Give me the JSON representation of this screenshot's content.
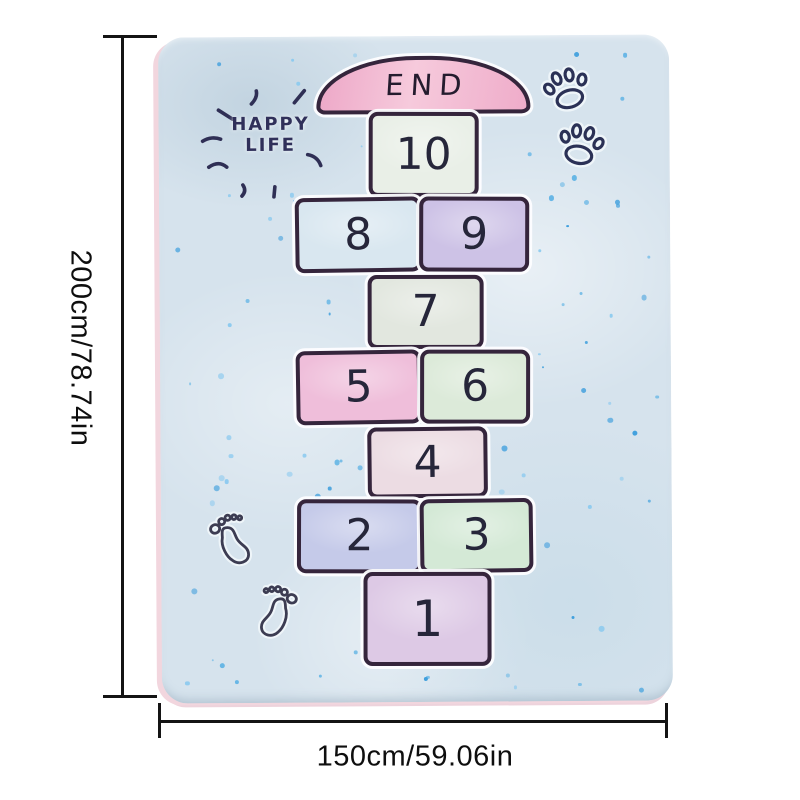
{
  "dimensions": {
    "height_label": "200cm/78.74in",
    "width_label": "150cm/59.06in",
    "line_color": "#141414"
  },
  "mat": {
    "background": "#d6e3ed",
    "edge_color": "#f2d6de",
    "outline_color": "#35253c",
    "number_color": "#26263a",
    "dot_colors": [
      "#3f9fdd",
      "#66b6e5",
      "#8ccaef"
    ],
    "happy_life": {
      "line1": "HAPPY",
      "line2": "LIFE",
      "color": "#30305a"
    },
    "end_cap": {
      "label": "END",
      "fill": "#f3b8d0"
    },
    "squares": {
      "s10": {
        "label": "10",
        "fill": "#e9efe7"
      },
      "s9": {
        "label": "9",
        "fill": "#cdc2e6"
      },
      "s8": {
        "label": "8",
        "fill": "#d9e7f0"
      },
      "s7": {
        "label": "7",
        "fill": "#e2e7df"
      },
      "s6": {
        "label": "6",
        "fill": "#dcead9"
      },
      "s5": {
        "label": "5",
        "fill": "#efbeda"
      },
      "s4": {
        "label": "4",
        "fill": "#ecdce3"
      },
      "s3": {
        "label": "3",
        "fill": "#d4e9d6"
      },
      "s2": {
        "label": "2",
        "fill": "#c5cae9"
      },
      "s1": {
        "label": "1",
        "fill": "#ddc9e5"
      }
    },
    "icons": {
      "paw_print": "paw-print-icon",
      "footprint": "footprint-icon",
      "rays": "sparkle-rays-icon"
    }
  }
}
